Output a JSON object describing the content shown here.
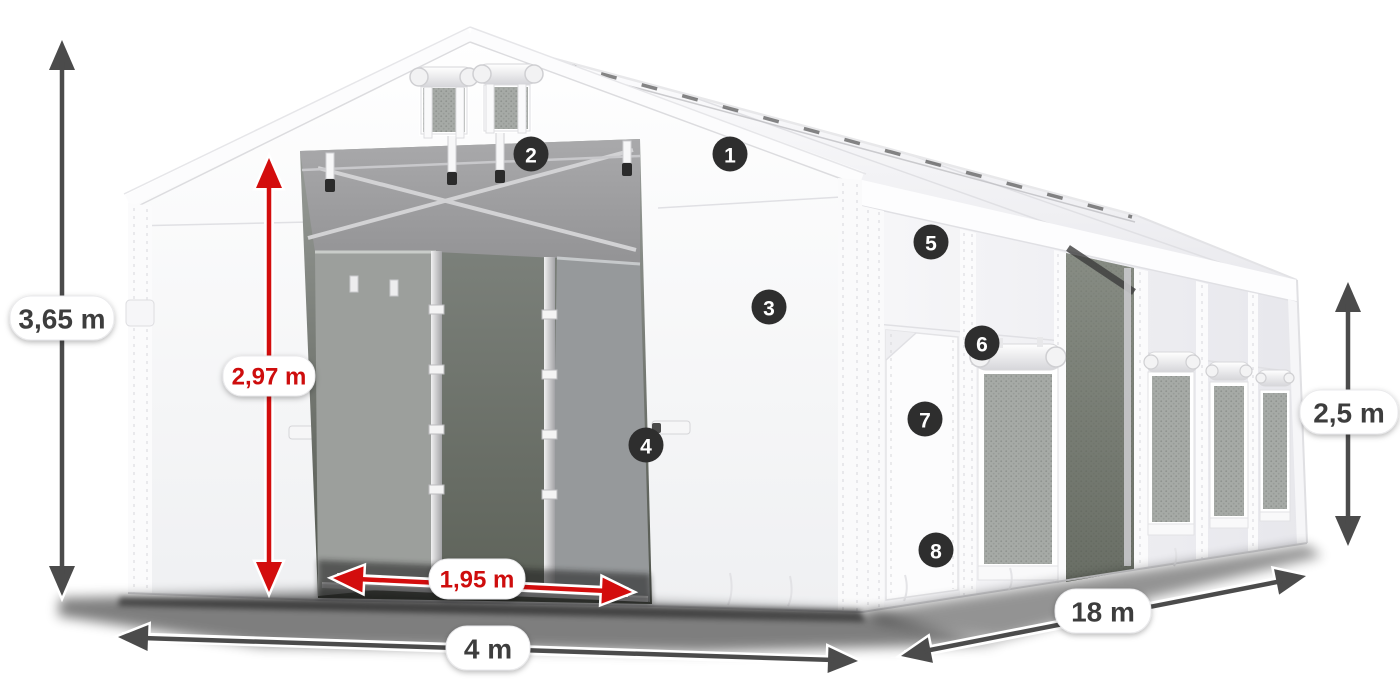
{
  "diagram": {
    "subject": "White tent hall product illustration with numbered feature callouts and dimension arrows"
  },
  "dimensions": {
    "total_height": {
      "label": "3,65 m"
    },
    "entrance_height": {
      "label": "2,97 m"
    },
    "entrance_width": {
      "label": "1,95 m"
    },
    "width": {
      "label": "4 m"
    },
    "length": {
      "label": "18 m"
    },
    "side_height": {
      "label": "2,5 m"
    }
  },
  "callouts": [
    "1",
    "2",
    "3",
    "4",
    "5",
    "6",
    "7",
    "8"
  ],
  "colors": {
    "arrow_primary": "#4b4b4b",
    "arrow_highlight": "#d30d0d",
    "label_text": "#3d3d3d",
    "label_highlight_text": "#ce0d0d",
    "badge_background": "#2e2e2e",
    "badge_text": "#ffffff",
    "canvas_background": "#ffffff"
  }
}
